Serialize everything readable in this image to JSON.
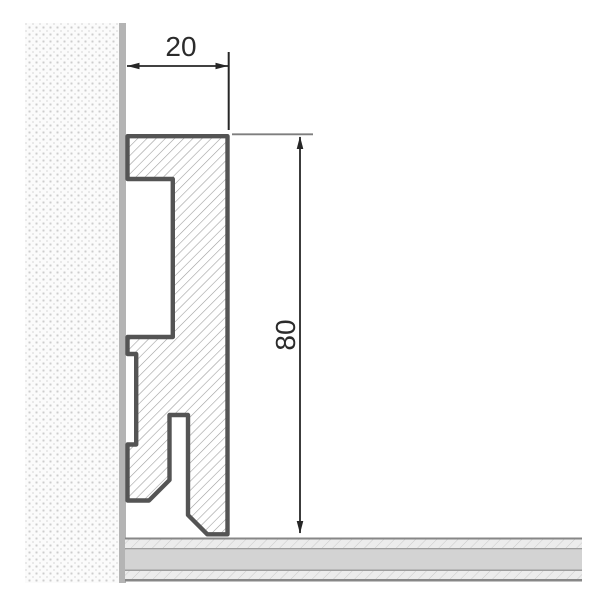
{
  "drawing": {
    "kind": "skirting-profile-cross-section",
    "dimensions": {
      "width": {
        "value": "20"
      },
      "height": {
        "value": "80"
      }
    },
    "colors": {
      "background": "#ffffff",
      "profile_outline": "#545454",
      "profile_hatch": "#9c9c9c",
      "dimension_lines": "#262626",
      "extension_line": "#7e7e7e",
      "wall_edge": "#b4b4b4",
      "wall_dots": "#cdcdcd",
      "floor_solid_band": "#d3d3d3",
      "floor_hatch_bg": "#ececec",
      "floor_border_lines": "#878787"
    }
  }
}
